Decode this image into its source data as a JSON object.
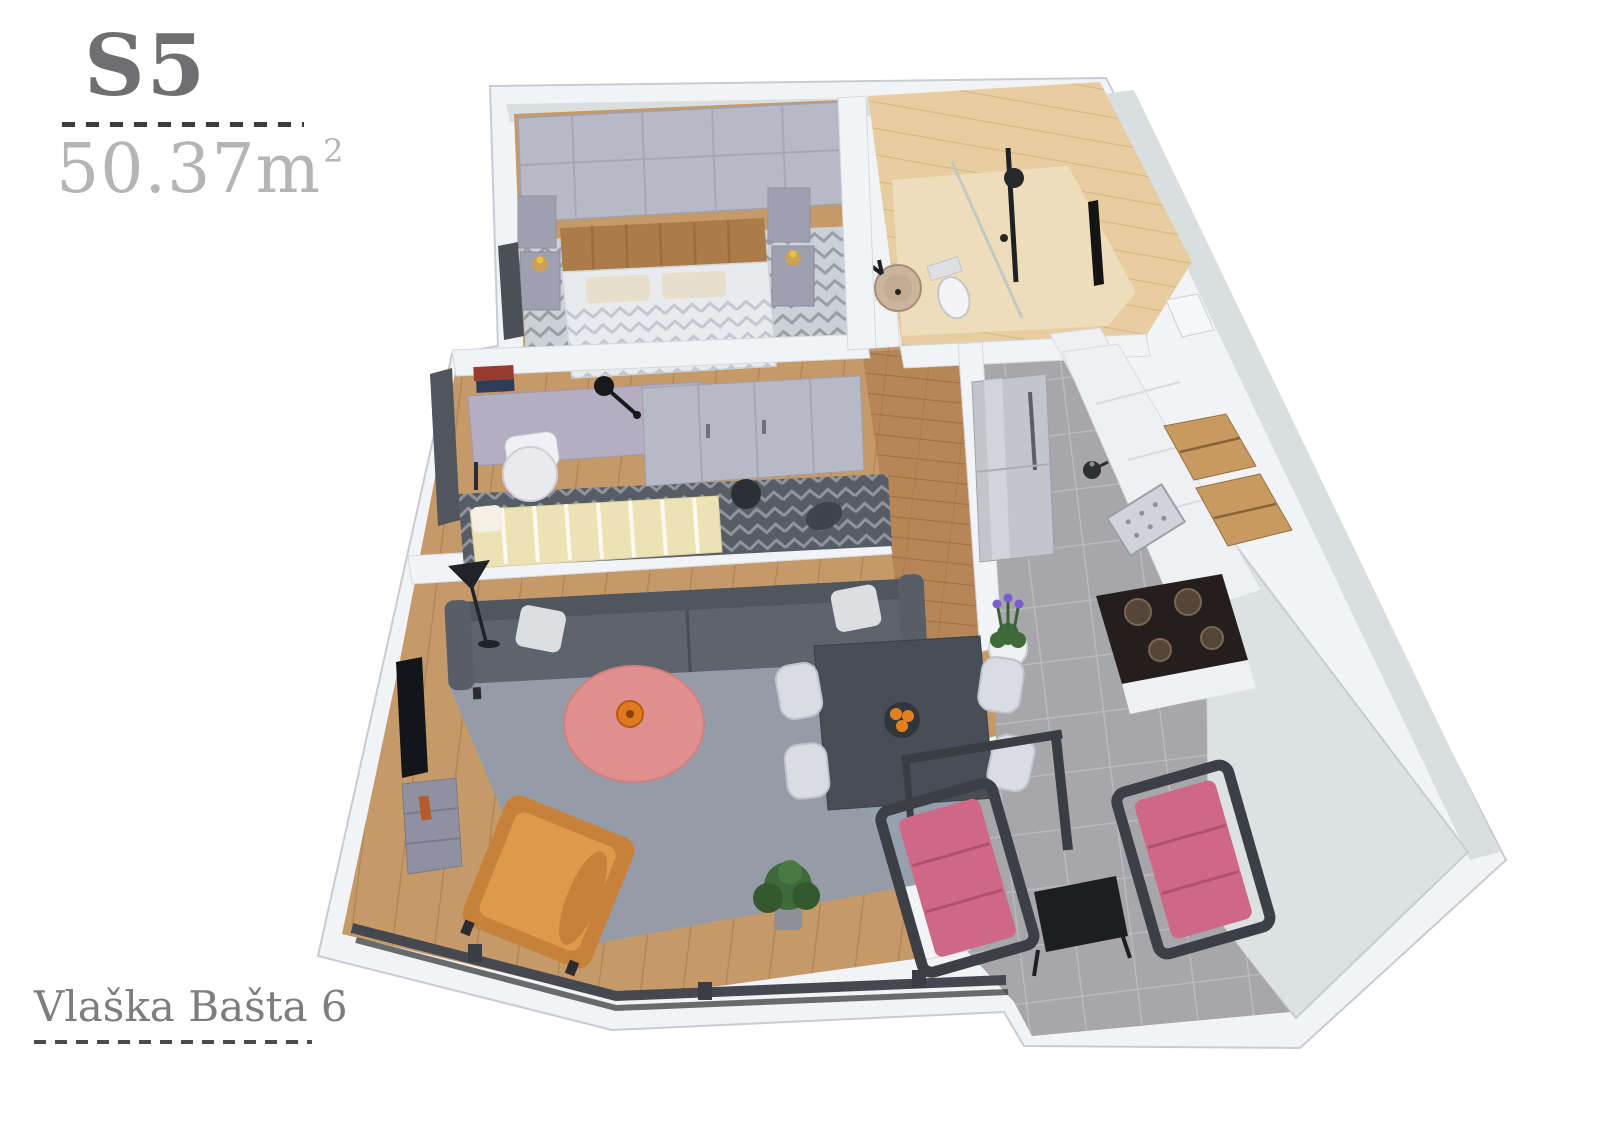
{
  "labels": {
    "unit": "S5",
    "area": "50.37",
    "area_unit": "m",
    "area_exponent": "2",
    "address": "Vlaška Bašta 6"
  },
  "colors": {
    "background": "#ffffff",
    "wall": "#f2f3f6",
    "wall_edge": "#c8cbd2",
    "wall_interior_mint": "#d8dfde",
    "terrace_wall": "#dce2e2",
    "wood_floor": "#c59a68",
    "wood_hall": "#ab7748",
    "tile": "#a7a7ab",
    "rug_living": "#939cab",
    "rug_dark": "#575d66",
    "bed_rug": "#ccd1d8",
    "sofa": "#5d646d",
    "pillow": "#dcdee2",
    "armchair": "#dd9a4a",
    "coffee_table": "#e08f8f",
    "vase": "#e0791e",
    "dining_table": "#474e57",
    "dining_chair": "#d9dce3",
    "terrace_chair": "#ce6886",
    "chair_frame": "#3c4046",
    "side_table": "#1c1e22",
    "wardrobe": "#b8b9c7",
    "headboard": "#ab7c48",
    "bed": "#e8eaee",
    "nightstand": "#9fa0af",
    "bathroom_wood": "#e8cda1",
    "bathroom_floor": "#eedfbe",
    "fixture_black": "#1f2125",
    "sink": "#cbb49e",
    "fridge": "#c2c6cc",
    "kitchen_cabinet": "#eef0f3",
    "kitchen_wood": "#c89a62",
    "stove": "#241f1c",
    "desk": "#b3aec2",
    "office_chair": "#e9e9ee",
    "daybed": "#ece2b4",
    "plant_green": "#3f6b3a",
    "lavender": "#7a5bd0",
    "window_frame": "#45484e",
    "label_unit_color": "#6f6f71",
    "label_area_color": "#b5b5b7",
    "label_address_color": "#7d7d7f",
    "dash_color": "#3d3d3d"
  }
}
